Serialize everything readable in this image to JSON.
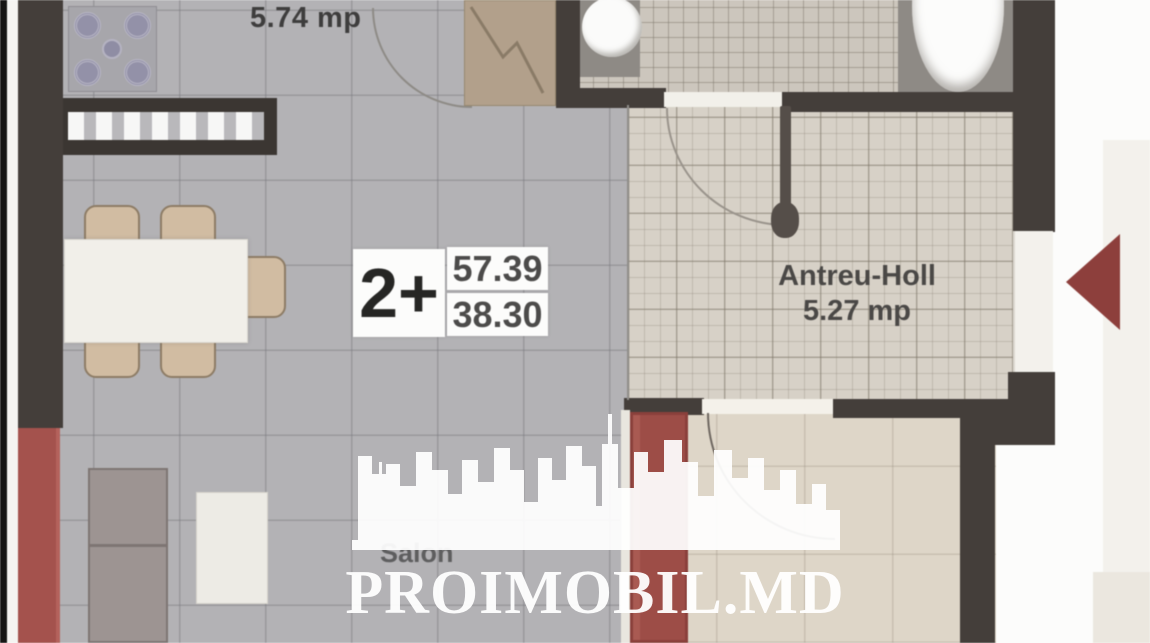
{
  "meta": {
    "type": "apartment-floor-plan"
  },
  "rooms": {
    "kitchen": {
      "area_label": "5.74 mp"
    },
    "hall": {
      "name": "Antreu-Holl",
      "area_label": "5.27 mp"
    },
    "salon": {
      "name": "Salon"
    }
  },
  "unit_badge": {
    "rooms": "2+",
    "total_area": "57.39",
    "living_area": "38.30"
  },
  "watermark": {
    "brand": "PROIMOBIL.MD"
  },
  "colors": {
    "wall": "#443e3a",
    "living_floor": "#b3b2b5",
    "hall_tile": "#d7d1c7",
    "bedroom_floor": "#ded6c8",
    "accent_red": "#9d4d47",
    "entrance_arrow": "#8d3f3c",
    "watermark": "#ffffff"
  }
}
